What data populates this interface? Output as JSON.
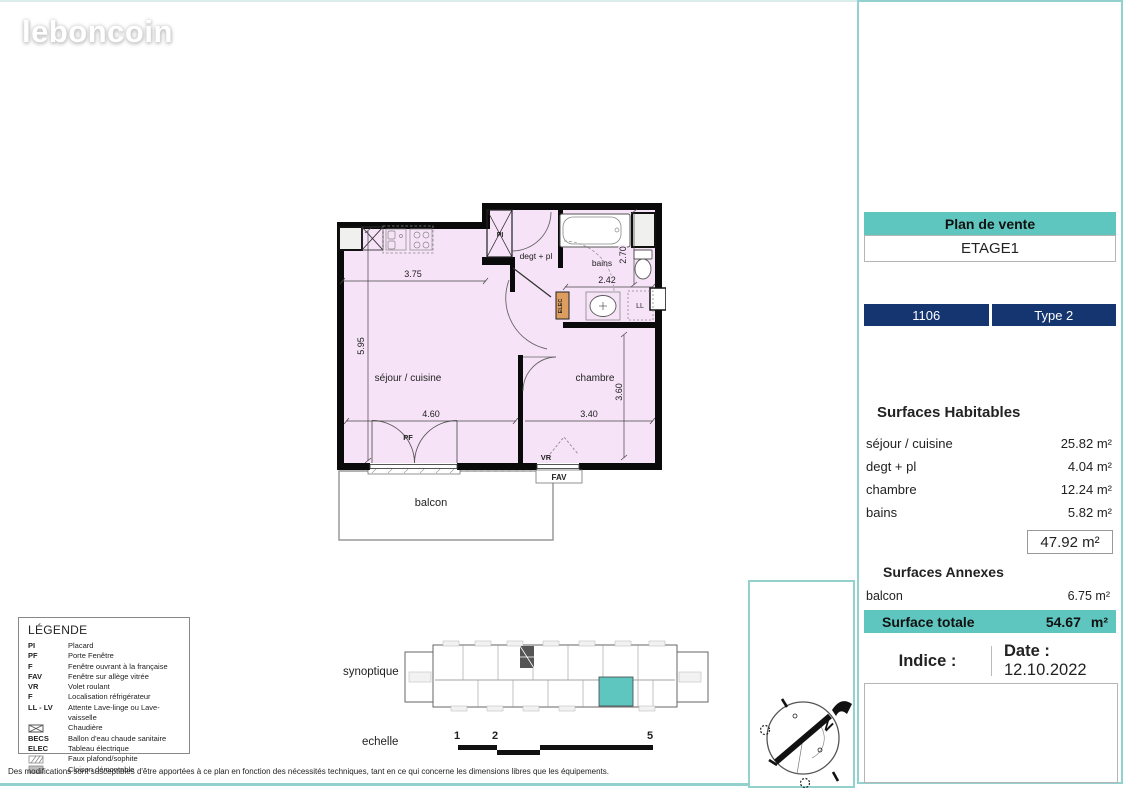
{
  "colors": {
    "teal": "#5fc6bf",
    "teal-border": "#92d1cd",
    "navy": "#14356f",
    "plan-pink": "#f7e3f7",
    "elec-orange": "#dd9d5e",
    "gray-border": "#b5b5b5"
  },
  "logo": {
    "text": "leboncoin"
  },
  "panel": {
    "title": "Plan de vente",
    "etage": "ETAGE1",
    "lot": "1106",
    "type": "Type 2",
    "surfaces_habitables": {
      "heading": "Surfaces Habitables",
      "rows": [
        {
          "label": "séjour / cuisine",
          "value": "25.82 m²"
        },
        {
          "label": "degt + pl",
          "value": "4.04 m²"
        },
        {
          "label": "chambre",
          "value": "12.24 m²"
        },
        {
          "label": "bains",
          "value": "5.82 m²"
        }
      ],
      "total": "47.92 m²"
    },
    "surfaces_annexes": {
      "heading": "Surfaces Annexes",
      "rows": [
        {
          "label": "balcon",
          "value": "6.75 m²"
        }
      ]
    },
    "surface_totale": {
      "label": "Surface totale",
      "value": "54.67",
      "unit": "m²"
    },
    "indice_label": "Indice :",
    "date_label": "Date :",
    "date_value": "12.10.2022"
  },
  "plan": {
    "rooms": {
      "sejour": "séjour / cuisine",
      "chambre": "chambre",
      "bains": "bains",
      "degt": "degt + pl",
      "balcon": "balcon"
    },
    "tags": {
      "pi": "PI",
      "pf": "PF",
      "vr": "VR",
      "fav": "FAV",
      "ll": "LL",
      "elec": "ELEC"
    },
    "dims": {
      "sejour_top": "3.75",
      "sejour_h": "5.95",
      "sejour_w": "4.60",
      "bains_w": "2.42",
      "bains_h": "2.70",
      "chambre_w": "3.40",
      "chambre_h": "3.60"
    }
  },
  "legend": {
    "title": "LÉGENDE",
    "items": [
      {
        "abbr": "PI",
        "label": "Placard"
      },
      {
        "abbr": "PF",
        "label": "Porte Fenêtre"
      },
      {
        "abbr": "F",
        "label": "Fenêtre ouvrant à la française"
      },
      {
        "abbr": "FAV",
        "label": "Fenêtre sur allège vitrée"
      },
      {
        "abbr": "VR",
        "label": "Volet roulant"
      },
      {
        "abbr": "F",
        "label": "Localisation réfrigérateur"
      },
      {
        "abbr": "LL - LV",
        "label": "Attente Lave-linge ou Lave-vaisselle"
      },
      {
        "abbr": "",
        "icon": "crossed-box-icon",
        "label": "Chaudière"
      },
      {
        "abbr": "BECS",
        "label": "Ballon d'eau chaude sanitaire"
      },
      {
        "abbr": "ELEC",
        "label": "Tableau électrique"
      },
      {
        "abbr": "",
        "icon": "hatched-box-icon",
        "label": "Faux plafond/sophite"
      },
      {
        "abbr": "",
        "icon": "gray-box-icon",
        "label": "Cloison démontable"
      }
    ]
  },
  "synoptique_label": "synoptique",
  "echelle": {
    "label": "echelle",
    "marks": [
      "1",
      "2",
      "5"
    ]
  },
  "compass": {
    "north": "N"
  },
  "disclaimer": "Des modifications sont susceptibles d'être apportées à ce plan en fonction des nécessités techniques, tant en ce qui concerne les dimensions libres que les équipements."
}
